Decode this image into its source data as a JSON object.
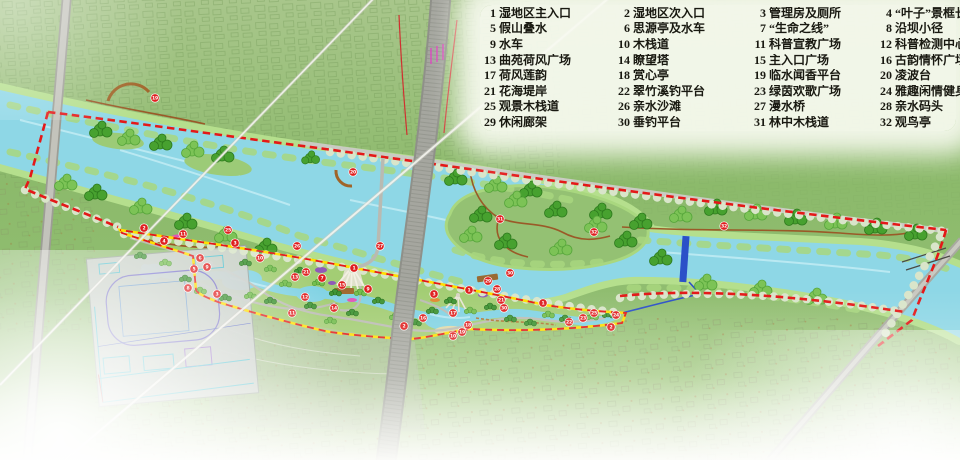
{
  "legend": {
    "items": [
      {
        "n": "1",
        "label": "湿地区主入口"
      },
      {
        "n": "2",
        "label": "湿地区次入口"
      },
      {
        "n": "3",
        "label": "管理房及厕所"
      },
      {
        "n": "4",
        "label": "“叶子”景框长廊"
      },
      {
        "n": "5",
        "label": "假山叠水"
      },
      {
        "n": "6",
        "label": "思源亭及水车"
      },
      {
        "n": "7",
        "label": "“生命之线”"
      },
      {
        "n": "8",
        "label": "沿坝小径"
      },
      {
        "n": "9",
        "label": "水车"
      },
      {
        "n": "10",
        "label": "木栈道"
      },
      {
        "n": "11",
        "label": "科普宣教广场"
      },
      {
        "n": "12",
        "label": "科普检测中心"
      },
      {
        "n": "13",
        "label": "曲苑荷风广场"
      },
      {
        "n": "14",
        "label": "瞭望塔"
      },
      {
        "n": "15",
        "label": "主入口广场"
      },
      {
        "n": "16",
        "label": "古韵情怀广场"
      },
      {
        "n": "17",
        "label": "荷风莲韵"
      },
      {
        "n": "18",
        "label": "赏心亭"
      },
      {
        "n": "19",
        "label": "临水闻香平台"
      },
      {
        "n": "20",
        "label": "凌波台"
      },
      {
        "n": "21",
        "label": "花海堤岸"
      },
      {
        "n": "22",
        "label": "翠竹溪钓平台"
      },
      {
        "n": "23",
        "label": "绿茵欢歌广场"
      },
      {
        "n": "24",
        "label": "雅趣闲情健身广场"
      },
      {
        "n": "25",
        "label": "观景木栈道"
      },
      {
        "n": "26",
        "label": "亲水沙滩"
      },
      {
        "n": "27",
        "label": "漫水桥"
      },
      {
        "n": "28",
        "label": "亲水码头"
      },
      {
        "n": "29",
        "label": "休闲廊架"
      },
      {
        "n": "30",
        "label": "垂钓平台"
      },
      {
        "n": "31",
        "label": "林中木栈道"
      },
      {
        "n": "32",
        "label": "观鸟亭"
      }
    ]
  },
  "map": {
    "colors": {
      "boundary_red": "#e41818",
      "boundary_yellow": "#ffdf00",
      "water": "#8ed7e6",
      "bank_green": "#b5df8d",
      "tree_green": "#47a12f",
      "marker_red": "#df1f1f",
      "dam_blue": "#2b50c8",
      "boardwalk_brown": "#9a5a28"
    },
    "markers": [
      {
        "n": "19",
        "x": 155,
        "y": 98
      },
      {
        "n": "20",
        "x": 353,
        "y": 172
      },
      {
        "n": "27",
        "x": 380,
        "y": 246
      },
      {
        "n": "31",
        "x": 500,
        "y": 219
      },
      {
        "n": "32",
        "x": 594,
        "y": 232
      },
      {
        "n": "32",
        "x": 724,
        "y": 226
      },
      {
        "n": "30",
        "x": 510,
        "y": 273
      },
      {
        "n": "29",
        "x": 488,
        "y": 281
      },
      {
        "n": "28",
        "x": 497,
        "y": 289
      },
      {
        "n": "2",
        "x": 144,
        "y": 228
      },
      {
        "n": "4",
        "x": 164,
        "y": 241
      },
      {
        "n": "11",
        "x": 183,
        "y": 234
      },
      {
        "n": "25",
        "x": 228,
        "y": 230
      },
      {
        "n": "3",
        "x": 235,
        "y": 243
      },
      {
        "n": "6",
        "x": 200,
        "y": 258
      },
      {
        "n": "5",
        "x": 194,
        "y": 269
      },
      {
        "n": "9",
        "x": 207,
        "y": 267
      },
      {
        "n": "10",
        "x": 260,
        "y": 258
      },
      {
        "n": "8",
        "x": 188,
        "y": 288
      },
      {
        "n": "3",
        "x": 217,
        "y": 294
      },
      {
        "n": "26",
        "x": 297,
        "y": 246
      },
      {
        "n": "13",
        "x": 295,
        "y": 277
      },
      {
        "n": "12",
        "x": 305,
        "y": 297
      },
      {
        "n": "11",
        "x": 292,
        "y": 313
      },
      {
        "n": "21",
        "x": 306,
        "y": 272
      },
      {
        "n": "7",
        "x": 322,
        "y": 278
      },
      {
        "n": "1",
        "x": 354,
        "y": 268
      },
      {
        "n": "15",
        "x": 342,
        "y": 285
      },
      {
        "n": "9",
        "x": 368,
        "y": 289
      },
      {
        "n": "14",
        "x": 334,
        "y": 308
      },
      {
        "n": "2",
        "x": 404,
        "y": 326
      },
      {
        "n": "16",
        "x": 423,
        "y": 318
      },
      {
        "n": "3",
        "x": 434,
        "y": 294
      },
      {
        "n": "1",
        "x": 469,
        "y": 290
      },
      {
        "n": "17",
        "x": 453,
        "y": 313
      },
      {
        "n": "18",
        "x": 468,
        "y": 325
      },
      {
        "n": "19",
        "x": 462,
        "y": 332
      },
      {
        "n": "10",
        "x": 453,
        "y": 336
      },
      {
        "n": "21",
        "x": 501,
        "y": 300
      },
      {
        "n": "30",
        "x": 504,
        "y": 308
      },
      {
        "n": "1",
        "x": 543,
        "y": 303
      },
      {
        "n": "22",
        "x": 569,
        "y": 322
      },
      {
        "n": "23",
        "x": 583,
        "y": 318
      },
      {
        "n": "25",
        "x": 594,
        "y": 313
      },
      {
        "n": "24",
        "x": 616,
        "y": 315
      },
      {
        "n": "2",
        "x": 611,
        "y": 327
      }
    ]
  }
}
